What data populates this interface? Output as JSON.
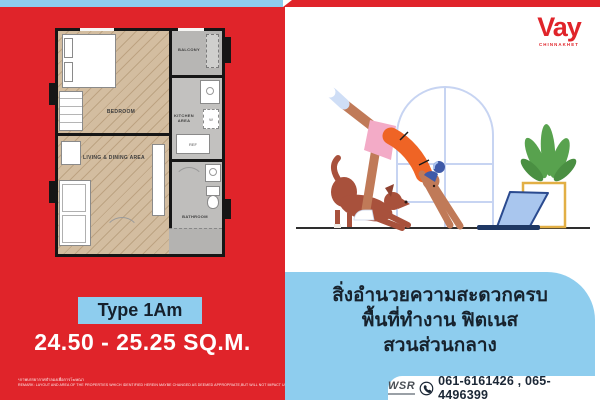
{
  "brand": {
    "name": "Vay",
    "location": "CHINNAKHET"
  },
  "unit": {
    "type": "Type 1Am",
    "area": "24.50 - 25.25 SQ.M."
  },
  "floorplan": {
    "bedroom": "BEDROOM",
    "balcony": "BALCONY",
    "kitchen": "KITCHEN AREA",
    "living": "LIVING & DINING AREA",
    "bathroom": "BATHROOM",
    "fridge": "REF",
    "washer": "W"
  },
  "amenities": {
    "line1": "สิ่งอำนวยความสะดวกครบ",
    "line2": "พื้นที่ทำงาน ฟิตเนส",
    "line3": "สวนส่วนกลาง"
  },
  "contact": {
    "agency": "WSR",
    "phones": "061-6161426 , 065-4496399"
  },
  "disclaimer": {
    "thai": "*ภาพบรรยากาศจำลองเพื่อการโฆษณา",
    "english": "REMARK: LAYOUT AND AREA OF THE PROPERTIES WHICH IDENTIFIED HEREIN MAYBE CHANGED AS DEEMED APPROPRIATE,BUT WILL NOT IMPACT UPON THE USE."
  },
  "colors": {
    "red": "#e0242a",
    "light_blue": "#8ecdee",
    "navy_text": "#1b2736",
    "orange_shirt": "#ef6425",
    "pink_shorts": "#f3abc7",
    "plant_green": "#58a24e",
    "dog_brown": "#a8513c"
  }
}
